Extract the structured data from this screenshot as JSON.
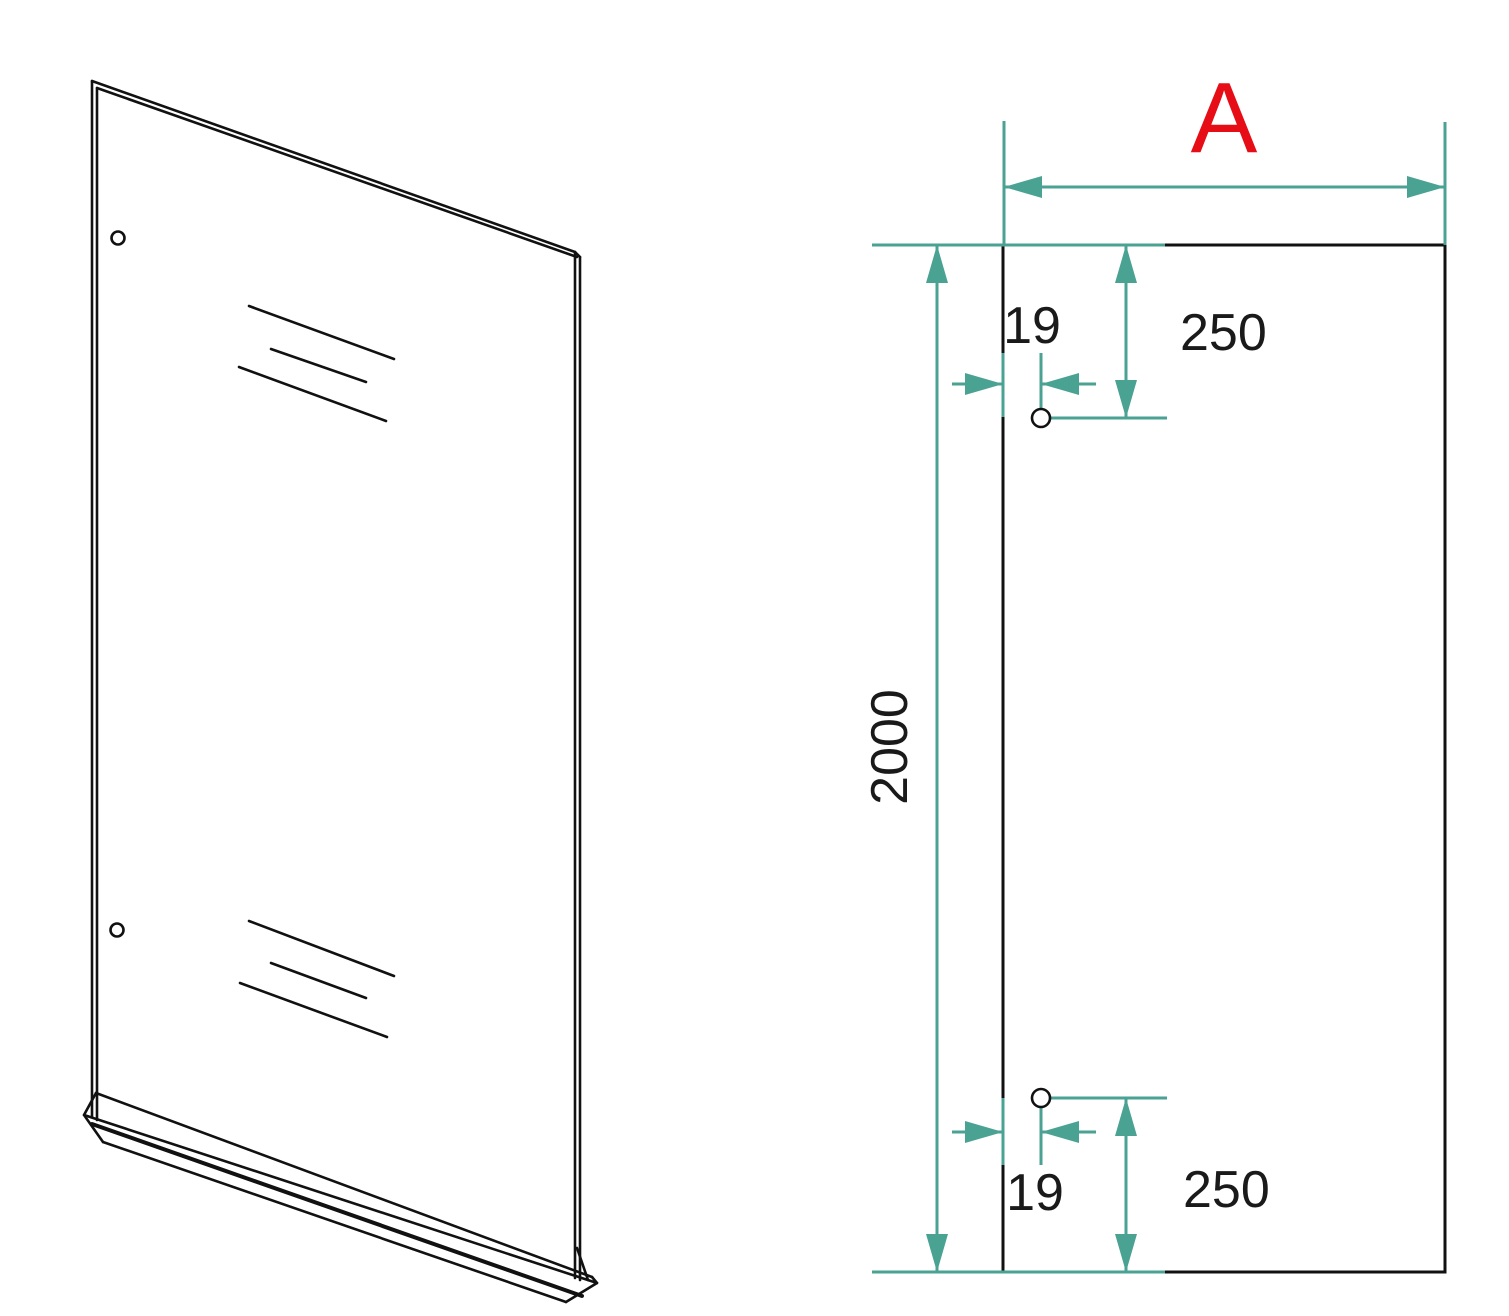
{
  "labels": {
    "width": "A",
    "height": "2000",
    "top": {
      "x_offset": "19",
      "y_offset": "250"
    },
    "bottom": {
      "x_offset": "19",
      "y_offset": "250"
    }
  },
  "colors": {
    "dimension_line": "#4aa293",
    "accent_label": "#e60d16",
    "drawing_line": "#111111"
  }
}
